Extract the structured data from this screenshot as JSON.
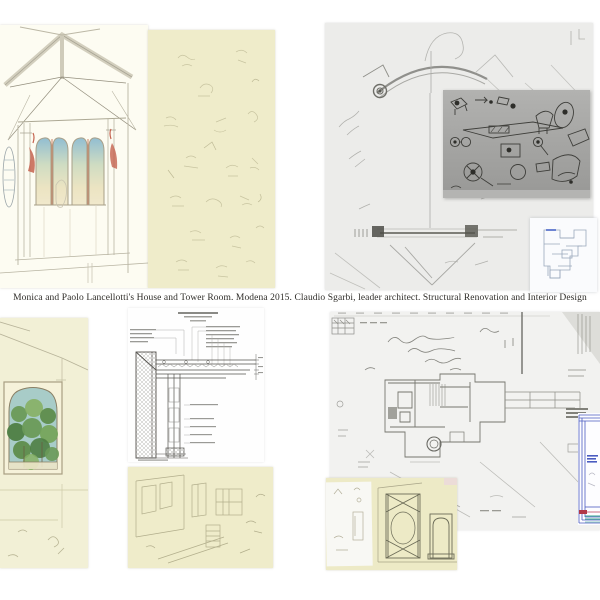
{
  "page": {
    "background": "#ffffff",
    "caption": "Monica and Paolo Lancellotti's House and Tower Room. Modena 2015.  Claudio Sgarbi, leader architect. Structural Renovation and Interior Design"
  },
  "palette": {
    "page_bg": "#ffffff",
    "cream_paper": "#fdfcf2",
    "yellow_paper": "#efecca",
    "grey_paper": "#ececea",
    "plan_paper": "#f2f2f0",
    "photo_grey": "#a4a4a2",
    "inset_plan_paper": "#fafbfd",
    "pencil_grey": "#9a9a96",
    "pencil_faint": "#c6c2a2",
    "sketch_ink": "#3e3e3a",
    "sky_blue": "#92bed2",
    "accent_red": "#c4624e",
    "foliage_green": "#5f9050",
    "cad_blue": "#4a5cc0",
    "mark_teal": "#3aa890",
    "mark_red": "#b03848"
  }
}
